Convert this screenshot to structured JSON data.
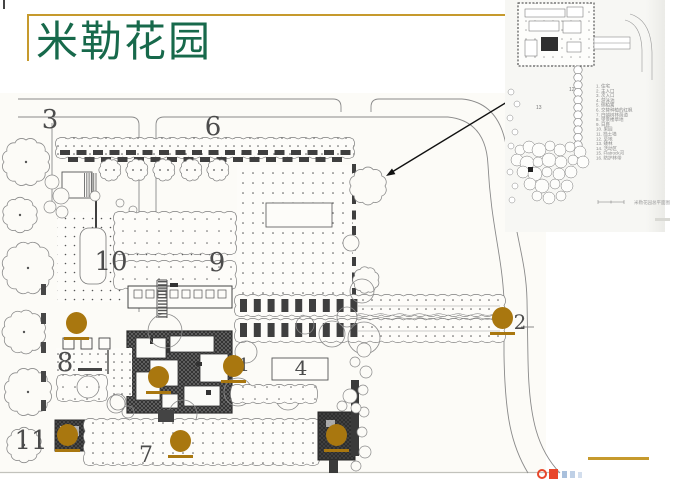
{
  "slide": {
    "title": "米勒花园"
  },
  "colors": {
    "title_green": "#17694B",
    "accent_gold": "#C69A2D",
    "marker_dot": "#A9770F",
    "logo_red": "#E8472B",
    "logo_blue": "#A9C0DC"
  },
  "plan": {
    "labels": [
      {
        "text": "3"
      },
      {
        "text": "6"
      },
      {
        "text": "10"
      },
      {
        "text": "9"
      },
      {
        "text": "8"
      },
      {
        "text": "1"
      },
      {
        "text": "4"
      },
      {
        "text": "2"
      },
      {
        "text": "11"
      },
      {
        "text": "7"
      }
    ]
  },
  "inset": {
    "plan_numbers": [
      "12",
      "13"
    ],
    "legend": [
      "1. 住宅",
      "2. 主入口",
      "3. 次入口",
      "4. 游泳池",
      "5. 侧柏篱",
      "6. 交替种植的红枫",
      "7. 白蜡树林荫道",
      "8. 望景楼草地",
      "9. 日晷",
      "10. 果园",
      "11. 挡土墙",
      "12. 草地",
      "13. 矮林",
      "14. 活动区",
      "15. Flatrock河",
      "16. 防护林带"
    ],
    "caption": "米勒花园总平面图"
  }
}
